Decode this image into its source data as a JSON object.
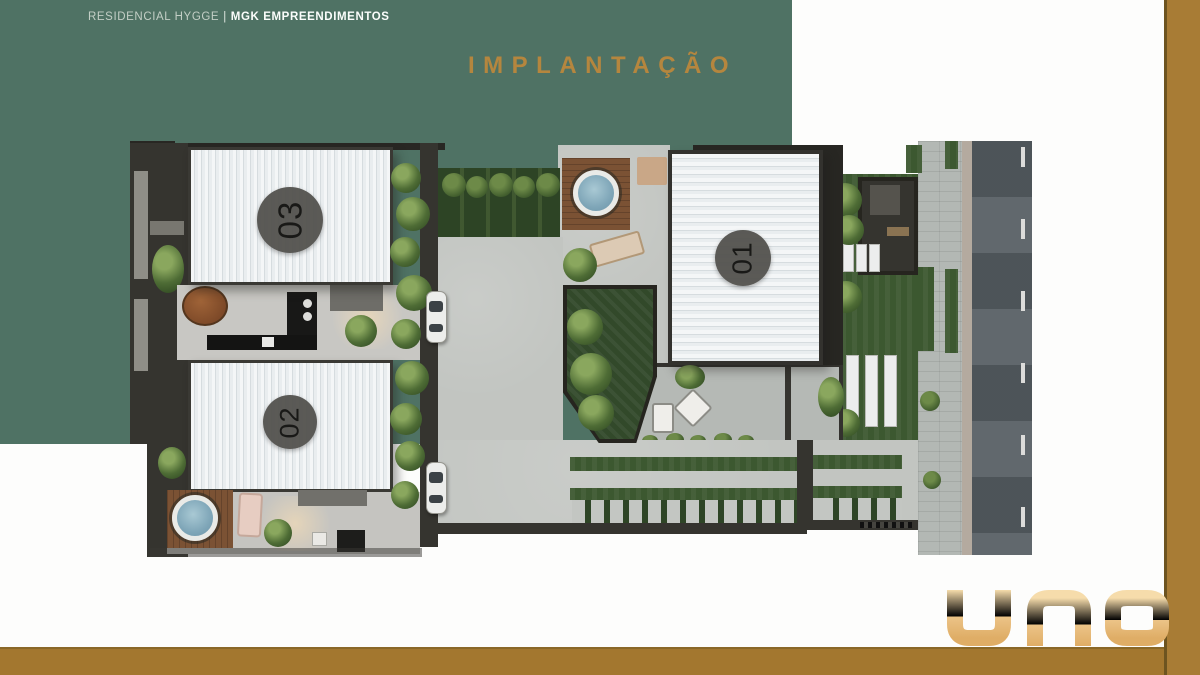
{
  "header": {
    "project": "RESIDENCIAL HYGGE",
    "separator": "|",
    "company": "MGK EMPREENDIMENTOS"
  },
  "title": "IMPLANTAÇÃO",
  "site_plan": {
    "description": "top-down implantation render of three residential units with courtyard, decks, hot tubs, gardens, driveway and street",
    "units": [
      {
        "label": "01"
      },
      {
        "label": "02"
      },
      {
        "label": "03"
      }
    ]
  },
  "brand": {
    "logo_text": "una"
  },
  "colors": {
    "panel_green": "#4f7264",
    "title_gold": "#b5863e",
    "frame_brown": "#a87c35",
    "logo_gold": "#edc58c"
  }
}
